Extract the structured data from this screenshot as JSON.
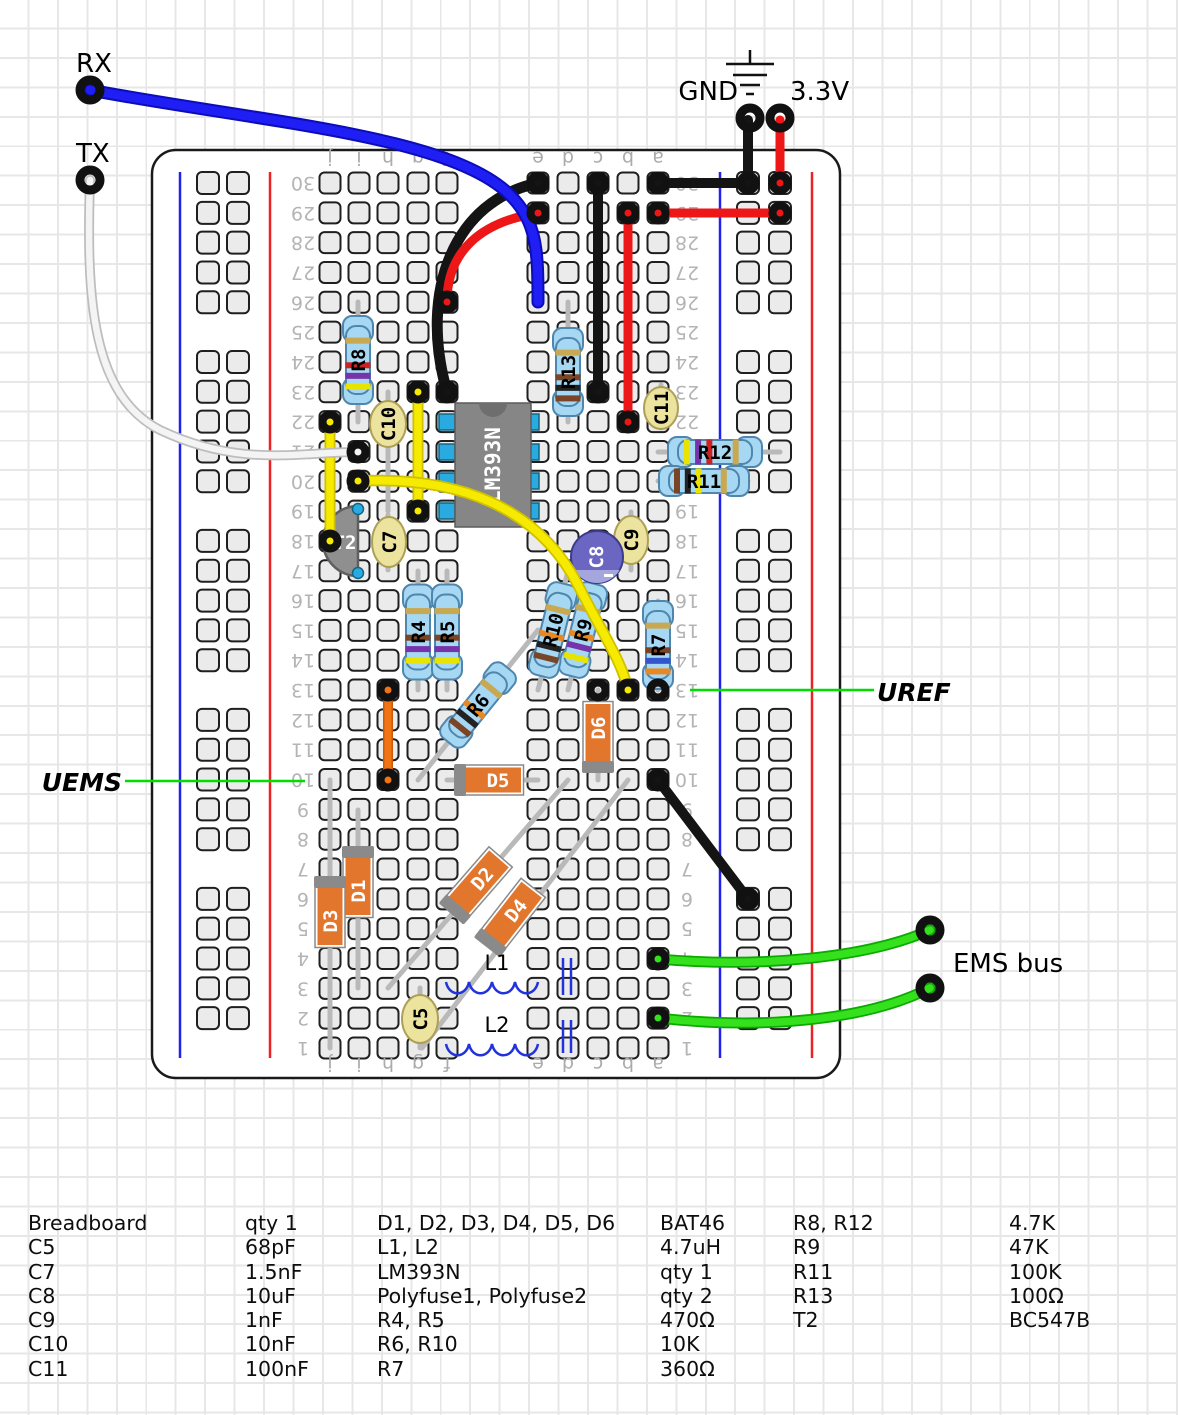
{
  "labels": {
    "rx": "RX",
    "tx": "TX",
    "gnd": "GND",
    "v33": "3.3V",
    "ems_bus": "EMS bus",
    "uems": "UEMS",
    "uref": "UREF"
  },
  "board": {
    "row_min": 1,
    "row_max": 30,
    "column_letters": [
      "j",
      "i",
      "h",
      "g",
      "f",
      "e",
      "d",
      "c",
      "b",
      "a"
    ]
  },
  "components": {
    "ic": {
      "label": "LM393N"
    },
    "t2": {
      "label": "T2"
    },
    "r4": {
      "label": "R4"
    },
    "r5": {
      "label": "R5"
    },
    "r6": {
      "label": "R6"
    },
    "r7": {
      "label": "R7"
    },
    "r8": {
      "label": "R8"
    },
    "r9": {
      "label": "R9"
    },
    "r10": {
      "label": "R10"
    },
    "r11": {
      "label": "R11"
    },
    "r12": {
      "label": "R12"
    },
    "r13": {
      "label": "R13"
    },
    "c5": {
      "label": "C5"
    },
    "c7": {
      "label": "C7"
    },
    "c8": {
      "label": "C8"
    },
    "c9": {
      "label": "C9"
    },
    "c10": {
      "label": "C10"
    },
    "c11": {
      "label": "C11"
    },
    "d1": {
      "label": "D1"
    },
    "d2": {
      "label": "D2"
    },
    "d3": {
      "label": "D3"
    },
    "d4": {
      "label": "D4"
    },
    "d5": {
      "label": "D5"
    },
    "d6": {
      "label": "D6"
    },
    "l1": {
      "label": "L1"
    },
    "l2": {
      "label": "L2"
    }
  },
  "colors": {
    "wire_blue": "#1a1af0",
    "wire_white": "#f4f4f4",
    "wire_black": "#141414",
    "wire_red": "#ee1717",
    "wire_yellow": "#f6ea00",
    "wire_orange": "#f07414",
    "wire_green": "#35e01c",
    "pointer_green": "#00dd00",
    "rail_blue": "#2222ee",
    "rail_red": "#ee2222",
    "resistor_body": "#a6d7f3",
    "diode_body": "#e2762d",
    "cap_tan": "#ece39f",
    "cap_electrolytic": "#6a66c2",
    "ic_body": "#868686"
  },
  "parts_list": {
    "groups": [
      {
        "rows": [
          {
            "name": "Breadboard",
            "value": "qty 1"
          },
          {
            "name": "C5",
            "value": "68pF"
          },
          {
            "name": "C7",
            "value": "1.5nF"
          },
          {
            "name": "C8",
            "value": "10uF"
          },
          {
            "name": "C9",
            "value": "1nF"
          },
          {
            "name": "C10",
            "value": "10nF"
          },
          {
            "name": "C11",
            "value": "100nF"
          }
        ]
      },
      {
        "rows": [
          {
            "name": "D1, D2, D3, D4, D5, D6",
            "value": "BAT46"
          },
          {
            "name": "L1, L2",
            "value": "4.7uH"
          },
          {
            "name": "LM393N",
            "value": "qty 1"
          },
          {
            "name": "Polyfuse1, Polyfuse2",
            "value": "qty 2"
          },
          {
            "name": "R4, R5",
            "value": "470Ω"
          },
          {
            "name": "R6, R10",
            "value": "10K"
          },
          {
            "name": "R7",
            "value": "360Ω"
          }
        ]
      },
      {
        "rows": [
          {
            "name": "R8, R12",
            "value": "4.7K"
          },
          {
            "name": "R9",
            "value": "47K"
          },
          {
            "name": "R11",
            "value": "100K"
          },
          {
            "name": "R13",
            "value": "100Ω"
          },
          {
            "name": "T2",
            "value": "BC547B"
          }
        ]
      }
    ]
  }
}
